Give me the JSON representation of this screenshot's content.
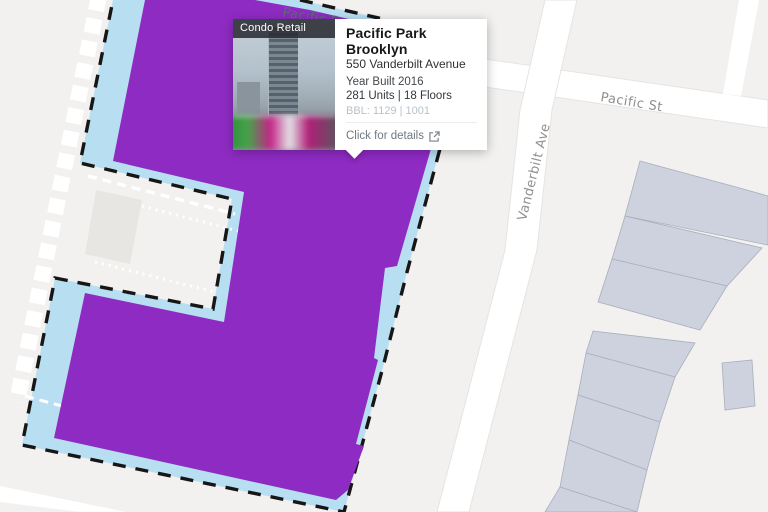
{
  "popup": {
    "category_label": "Condo Retail",
    "title": "Pacific Park Brooklyn",
    "address": "550 Vanderbilt Avenue",
    "year_built": "Year Built 2016",
    "units_floors": "281 Units | 18 Floors",
    "bbl": "BBL: 1129 | 1001",
    "cta_label": "Click for details"
  },
  "map": {
    "labels": {
      "pacific_st_west": "Pacific St",
      "pacific_st_east": "Pacific St",
      "vanderbilt_ave": "Vanderbilt Ave"
    },
    "colors": {
      "background": "#f2f1ef",
      "street": "#ffffff",
      "building_fill": "#cdd2de",
      "building_stroke": "#a8aebc",
      "notch_building_fill": "#e8e6e3",
      "block_highlight": "#b7dff1",
      "parcel_selected": "#8e2bc3",
      "boundary_dash": "#161616",
      "street_label": "#8f8f8f",
      "path_dash": "#ffffff"
    }
  }
}
